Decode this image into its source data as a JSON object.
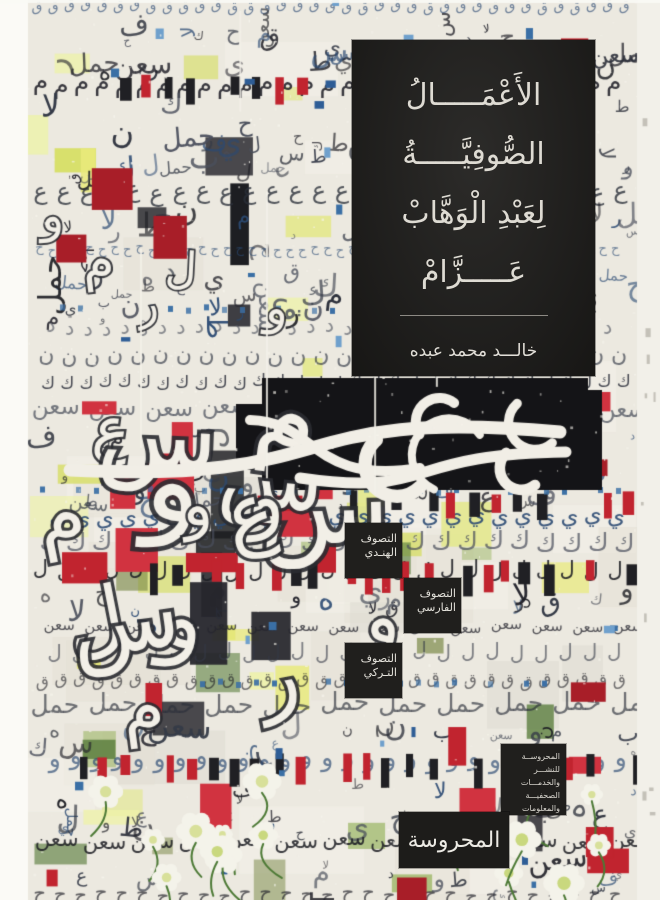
{
  "cover": {
    "title_box": {
      "lines": [
        "الأَعْمَـــــالُ",
        "الصُّوفِيَّـــــةُ",
        "لِعَبْدِ الْوَهَّابْ",
        "عَـــــزَّامْ"
      ],
      "author": "خالـــد محمد عبده"
    },
    "topics": [
      {
        "line1": "التصوف",
        "line2": "الهنـدي"
      },
      {
        "line1": "التصوف",
        "line2": "الفارسي"
      },
      {
        "line1": "التصوف",
        "line2": "التـركي"
      }
    ],
    "publisher": {
      "info_lines": [
        "المحروســة",
        "للنشـــر",
        "والخدمـــات",
        "الصحفيـــة",
        "والمعلومات"
      ],
      "logo": "المحروسة"
    },
    "palette": {
      "paper": "#ece9e0",
      "box_black": "#1f1e1c",
      "text_light": "#dedbd3",
      "red": "#c1242f",
      "yellow": "#e9ea7c",
      "blue": "#3a6fa5",
      "green": "#4d7a36",
      "ink": "#26262e"
    }
  }
}
